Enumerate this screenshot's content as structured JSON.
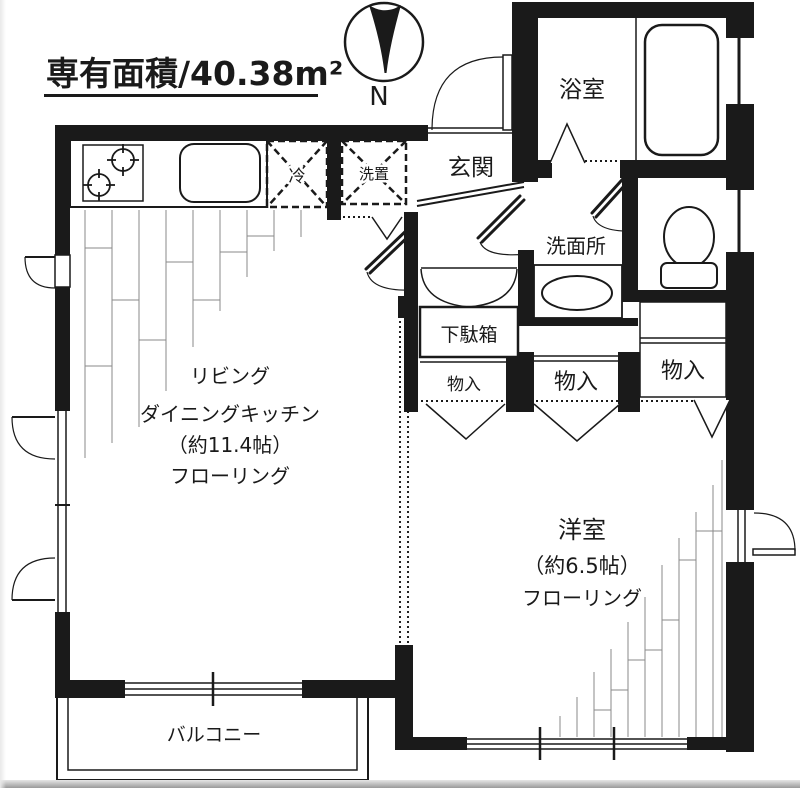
{
  "title": "専有面積/40.38m²",
  "compass": {
    "north_label": "N"
  },
  "rooms": {
    "bath": {
      "name": "浴室"
    },
    "entrance": {
      "name": "玄関"
    },
    "washroom": {
      "name": "洗面所"
    },
    "ldk": {
      "line1": "リビング",
      "line2": "ダイニングキッチン",
      "line3": "（約11.4帖）",
      "line4": "フローリング"
    },
    "western_room": {
      "line1": "洋室",
      "line2": "（約6.5帖）",
      "line3": "フローリング"
    },
    "balcony": {
      "name": "バルコニー"
    }
  },
  "fixtures": {
    "shoe_cabinet": {
      "name": "下駄箱"
    },
    "refrigerator_space": {
      "name": "冷"
    },
    "washer_space": {
      "name": "洗置"
    },
    "storage_left": {
      "name": "物入"
    },
    "storage_middle": {
      "name": "物入"
    },
    "storage_right": {
      "name": "物入"
    }
  },
  "colors": {
    "wall": "#1a1a1a",
    "hatch": "#888888",
    "background": "#ffffff"
  }
}
